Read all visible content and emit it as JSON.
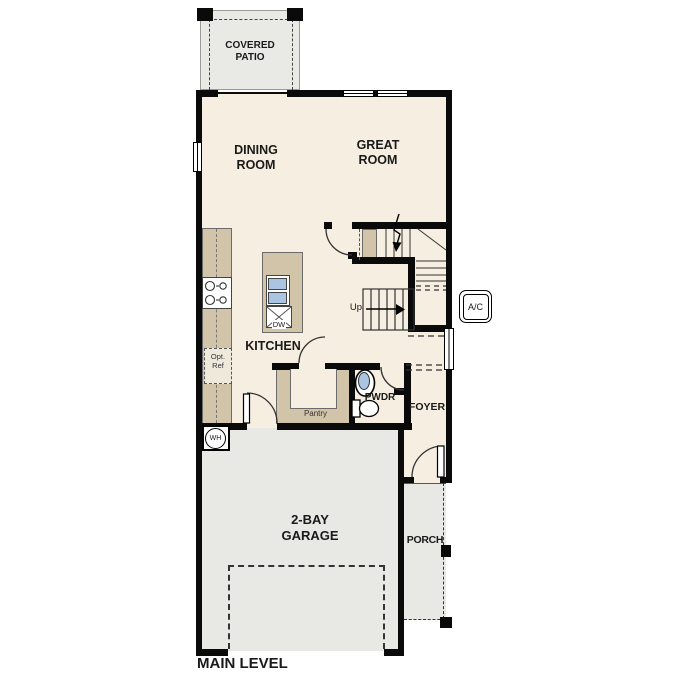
{
  "plan": {
    "title": "MAIN LEVEL",
    "rooms": {
      "covered_patio": "COVERED\nPATIO",
      "dining_room": "DINING\nROOM",
      "great_room": "GREAT\nROOM",
      "kitchen": "KITCHEN",
      "pantry": "Pantry",
      "powder": "PWDR",
      "foyer": "FOYER",
      "garage": "2-BAY\nGARAGE",
      "porch": "PORCH"
    },
    "annotations": {
      "stairs_up": "Up",
      "ac_unit": "A/C",
      "water_heater": "WH",
      "dishwasher": "DW",
      "optional_refrigerator": "Opt.\nRef"
    },
    "colors": {
      "floor": "#f5eee1",
      "cabinetry": "#d2c4a9",
      "concrete": "#e8e8e5",
      "wall": "#0a0a0a",
      "sink_blue": "#a9c5e1"
    }
  }
}
